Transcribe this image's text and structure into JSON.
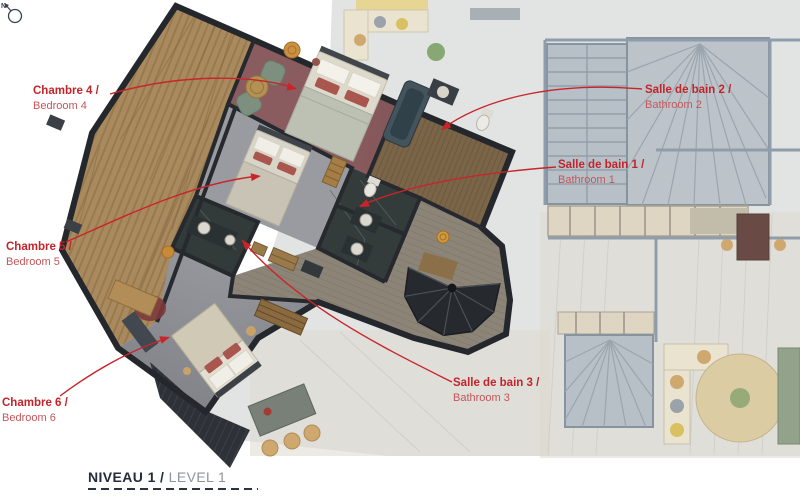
{
  "page": {
    "type": "architectural-floor-plan",
    "background": "#ffffff"
  },
  "labels": [
    {
      "id": "bedroom-4",
      "fr": "Chambre 4 /",
      "en": "Bedroom 4"
    },
    {
      "id": "bedroom-5",
      "fr": "Chambre 5 /",
      "en": "Bedroom 5"
    },
    {
      "id": "bedroom-6",
      "fr": "Chambre 6 /",
      "en": "Bedroom 6"
    },
    {
      "id": "bathroom-1",
      "fr": "Salle de bain 1 /",
      "en": "Bathroom 1"
    },
    {
      "id": "bathroom-2",
      "fr": "Salle de bain 2 /",
      "en": "Bathroom 2"
    },
    {
      "id": "bathroom-3",
      "fr": "Salle de bain 3 /",
      "en": "Bathroom 3"
    }
  ],
  "footer": {
    "level_fr": "NIVEAU 1 /",
    "level_en": "LEVEL 1",
    "compass_north": "N"
  },
  "colors": {
    "label_red": "#c2242a",
    "label_red_light": "#c4565b",
    "footer_dark": "#242e3a",
    "footer_gray": "#8d949c",
    "wall_dark": "#24272c",
    "terrace_wood": "#a98a5e",
    "carpet_bedroom4": "#7d5154",
    "carpet_bedroom5": "#868890",
    "carpet_bedroom6": "#7f8186",
    "bathroom_marble": "#343c3b",
    "corridor_wood": "#8d8478",
    "faded_plan": "#e2e4e3"
  }
}
